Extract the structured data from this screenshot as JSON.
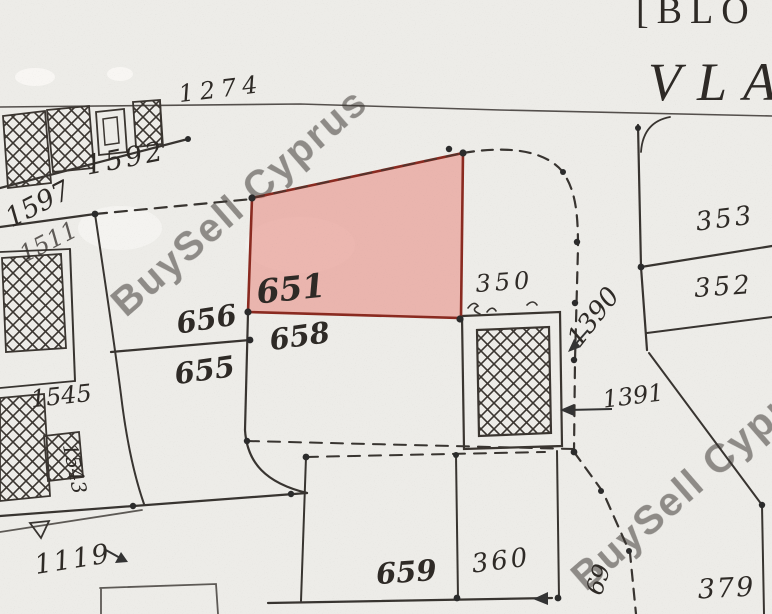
{
  "map": {
    "header": {
      "line1": "[BLO",
      "line2": "VLA"
    },
    "watermark": {
      "text": "BuySell Cyprus"
    },
    "highlight": {
      "parcel_number": "651",
      "fill_color": "#e87d73",
      "border_color": "#8a2a20"
    },
    "labels": {
      "n1274": "1274",
      "n1592": "1592",
      "n1597": "1597",
      "n1511": "1511",
      "n651": "651",
      "n656": "656",
      "n658": "658",
      "n655": "655",
      "n350": "350",
      "n353": "353",
      "n352": "352",
      "n1390": "1390",
      "n1391": "1391",
      "n1545": "1545",
      "n1543": "1543",
      "n1119": "1119",
      "n659": "659",
      "n360": "360",
      "n379": "379",
      "n69": "69"
    }
  }
}
